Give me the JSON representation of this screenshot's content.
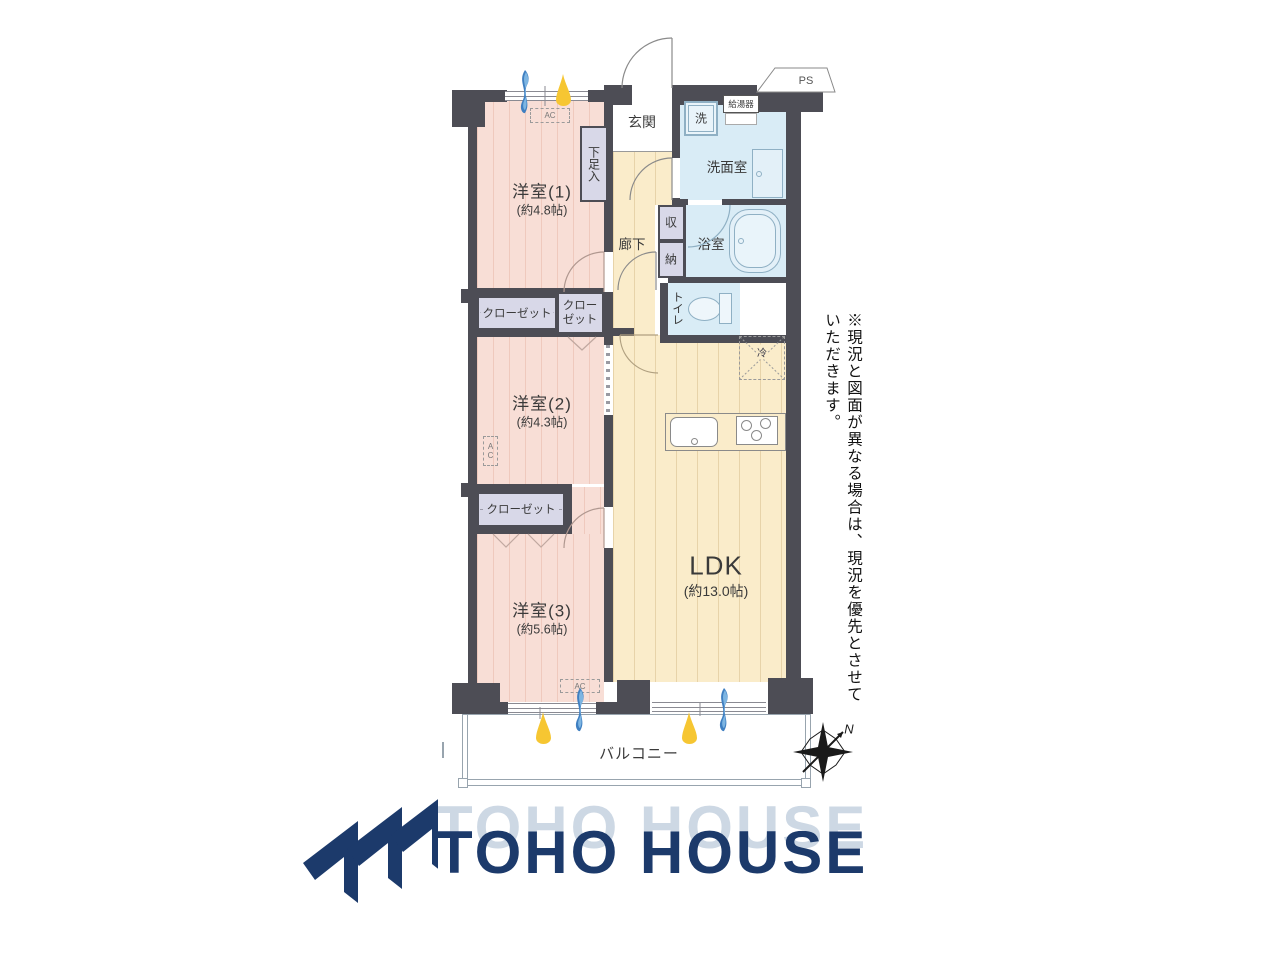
{
  "floorplan": {
    "rooms": {
      "room1_name": "洋室(1)",
      "room1_size": "(約4.8帖)",
      "room2_name": "洋室(2)",
      "room2_size": "(約4.3帖)",
      "room3_name": "洋室(3)",
      "room3_size": "(約5.6帖)",
      "ldk_name": "LDK",
      "ldk_size": "(約13.0帖)",
      "entrance": "玄関",
      "hallway": "廊下",
      "washroom": "洗面室",
      "bathroom": "浴室",
      "toilet": "トイレ",
      "storage_upper": "収",
      "storage_lower": "納",
      "washer": "洗",
      "water_heater": "給湯器",
      "shoe_box": "下足入",
      "closet_a": "クローゼット",
      "closet_b1": "クロー",
      "closet_b2": "ゼット",
      "closet_c": "クローゼット",
      "fridge": "冷",
      "balcony": "バルコニー",
      "pipe_space": "PS",
      "ac1": "AC",
      "ac2": "AC",
      "ac3": "AC"
    },
    "compass_n": "N",
    "disclaimer": "※現況と図面が異なる場合は、現況を優先とさせていただきます。",
    "colors": {
      "wall": "#4d4d55",
      "room_pink": "#f8ded6",
      "floor_cream": "#faecca",
      "wet_blue": "#d9ecf6",
      "closet_lavender": "#d8d8e8",
      "brand_navy": "#1c3a6b",
      "sun_yellow": "#f6c632",
      "wind_blue": "#3f7fc1"
    }
  },
  "footer": {
    "brand": "TOHO HOUSE"
  }
}
